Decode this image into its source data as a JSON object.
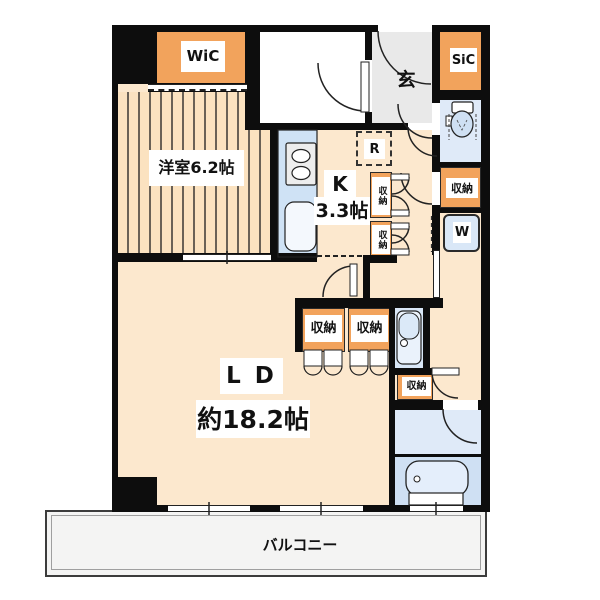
{
  "floorplan": {
    "title": "apartment-floor-plan",
    "labels": {
      "wic": "WiC",
      "western_room": "洋室6.2帖",
      "entrance": "玄",
      "sic": "SiC",
      "kitchen": "K",
      "kitchen_size": "3.3帖",
      "refrigerator": "R",
      "storage": "収納",
      "washer": "W",
      "living_dining": "L D",
      "living_dining_size": "約18.2帖",
      "balcony": "バルコニー"
    },
    "colors": {
      "wall": "#0d0d0d",
      "room_peach": "#fce8ce",
      "tatami_peach": "#fbe2c0",
      "stripe_line": "#6a6156",
      "storage_orange": "#f2a35c",
      "counter_blue": "#cfe2f5",
      "wet_blue_light": "#dfeaf8",
      "bath_blue": "#cfe0f3",
      "genkan_gray": "#e9e9e9",
      "balcony_gray": "#f4f4f3"
    },
    "icons": [
      "stove-icon",
      "sink-icon",
      "toilet-icon",
      "vanity-icon",
      "bathtub-icon",
      "washer-icon",
      "door-arc-icon",
      "sliding-door-icon",
      "bifold-door-icon",
      "window-icon",
      "refrigerator-dashed-box"
    ]
  }
}
